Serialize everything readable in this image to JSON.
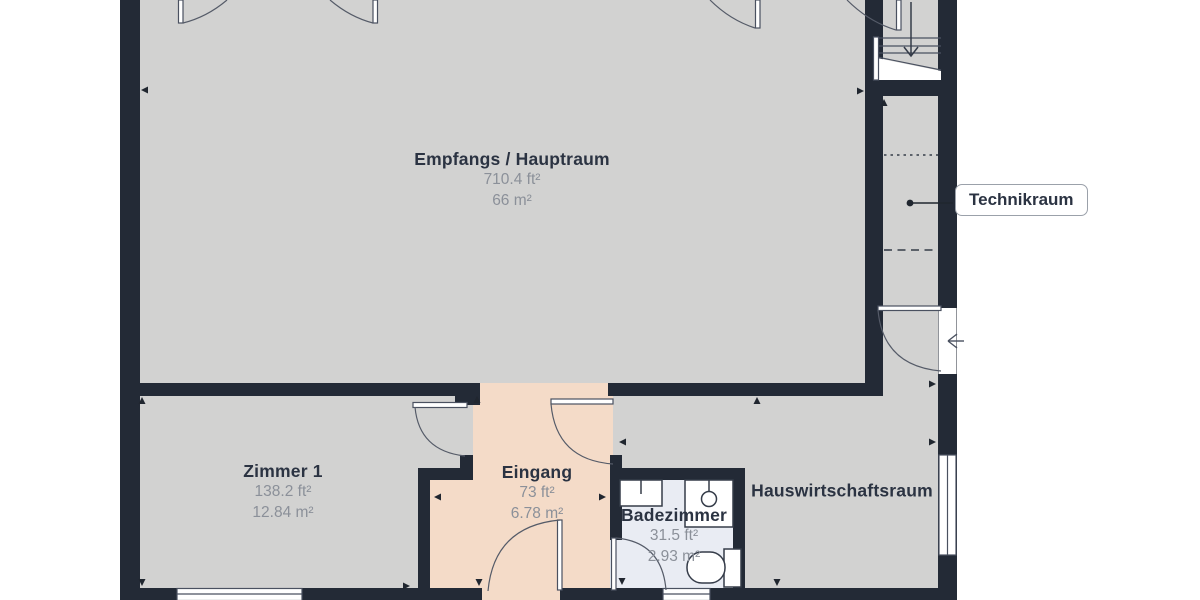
{
  "plan": {
    "type": "floorplan",
    "units_shown": [
      "ft²",
      "m²"
    ],
    "colors": {
      "wall": "#232a36",
      "floor_main": "#d2d2d1",
      "floor_entry": "#f4dbc8",
      "floor_bath": "#e9ecf3",
      "outside": "#ffffff",
      "thin_line": "#4a5160",
      "label_name": "#2b3342",
      "label_area": "#8b9099"
    }
  },
  "rooms": [
    {
      "name": "Empfangs / Hauptraum",
      "area_imperial": "710.4 ft²",
      "area_metric": "66 m²"
    },
    {
      "name": "Zimmer 1",
      "area_imperial": "138.2 ft²",
      "area_metric": "12.84 m²"
    },
    {
      "name": "Eingang",
      "area_imperial": "73 ft²",
      "area_metric": "6.78 m²"
    },
    {
      "name": "Badezimmer",
      "area_imperial": "31.5 ft²",
      "area_metric": "2.93 m²"
    },
    {
      "name": "Hauswirtschaftsraum"
    },
    {
      "name": "Technikraum"
    }
  ]
}
